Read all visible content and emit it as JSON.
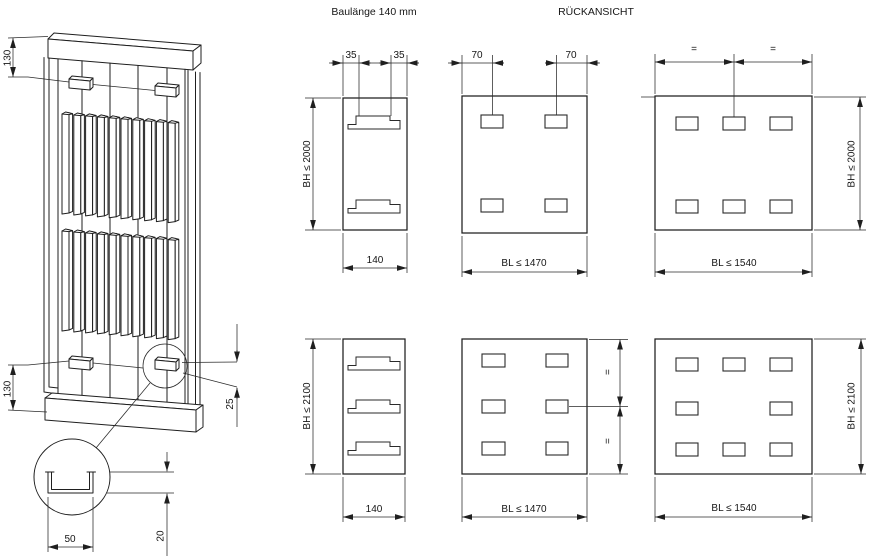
{
  "title_labels": {
    "construction_length": "Baulänge 140 mm",
    "rear_view": "RÜCKANSICHT"
  },
  "isometric_view": {
    "dim_top_bracket_offset": "130",
    "dim_bottom_bracket_offset": "130",
    "dim_rail_height": "25",
    "detail": {
      "dim_width": "50",
      "dim_depth": "20"
    }
  },
  "panels": {
    "top_narrow": {
      "dim_left": "35",
      "dim_right": "35",
      "height": "BH ≤ 2000",
      "width": "140"
    },
    "top_mid": {
      "dim_left": "70",
      "dim_right": "70",
      "width": "BL ≤ 1470"
    },
    "top_wide": {
      "eq_left": "=",
      "eq_right": "=",
      "height": "BH ≤ 2000",
      "width": "BL ≤ 1540"
    },
    "bottom_narrow": {
      "height": "BH ≤ 2100",
      "width": "140"
    },
    "bottom_mid": {
      "eq_upper": "=",
      "eq_lower": "=",
      "width": "BL ≤ 1470"
    },
    "bottom_wide": {
      "height": "BH ≤ 2100",
      "width": "BL ≤ 1540"
    }
  },
  "colors": {
    "line": "#1f1f1f",
    "background": "#ffffff"
  }
}
